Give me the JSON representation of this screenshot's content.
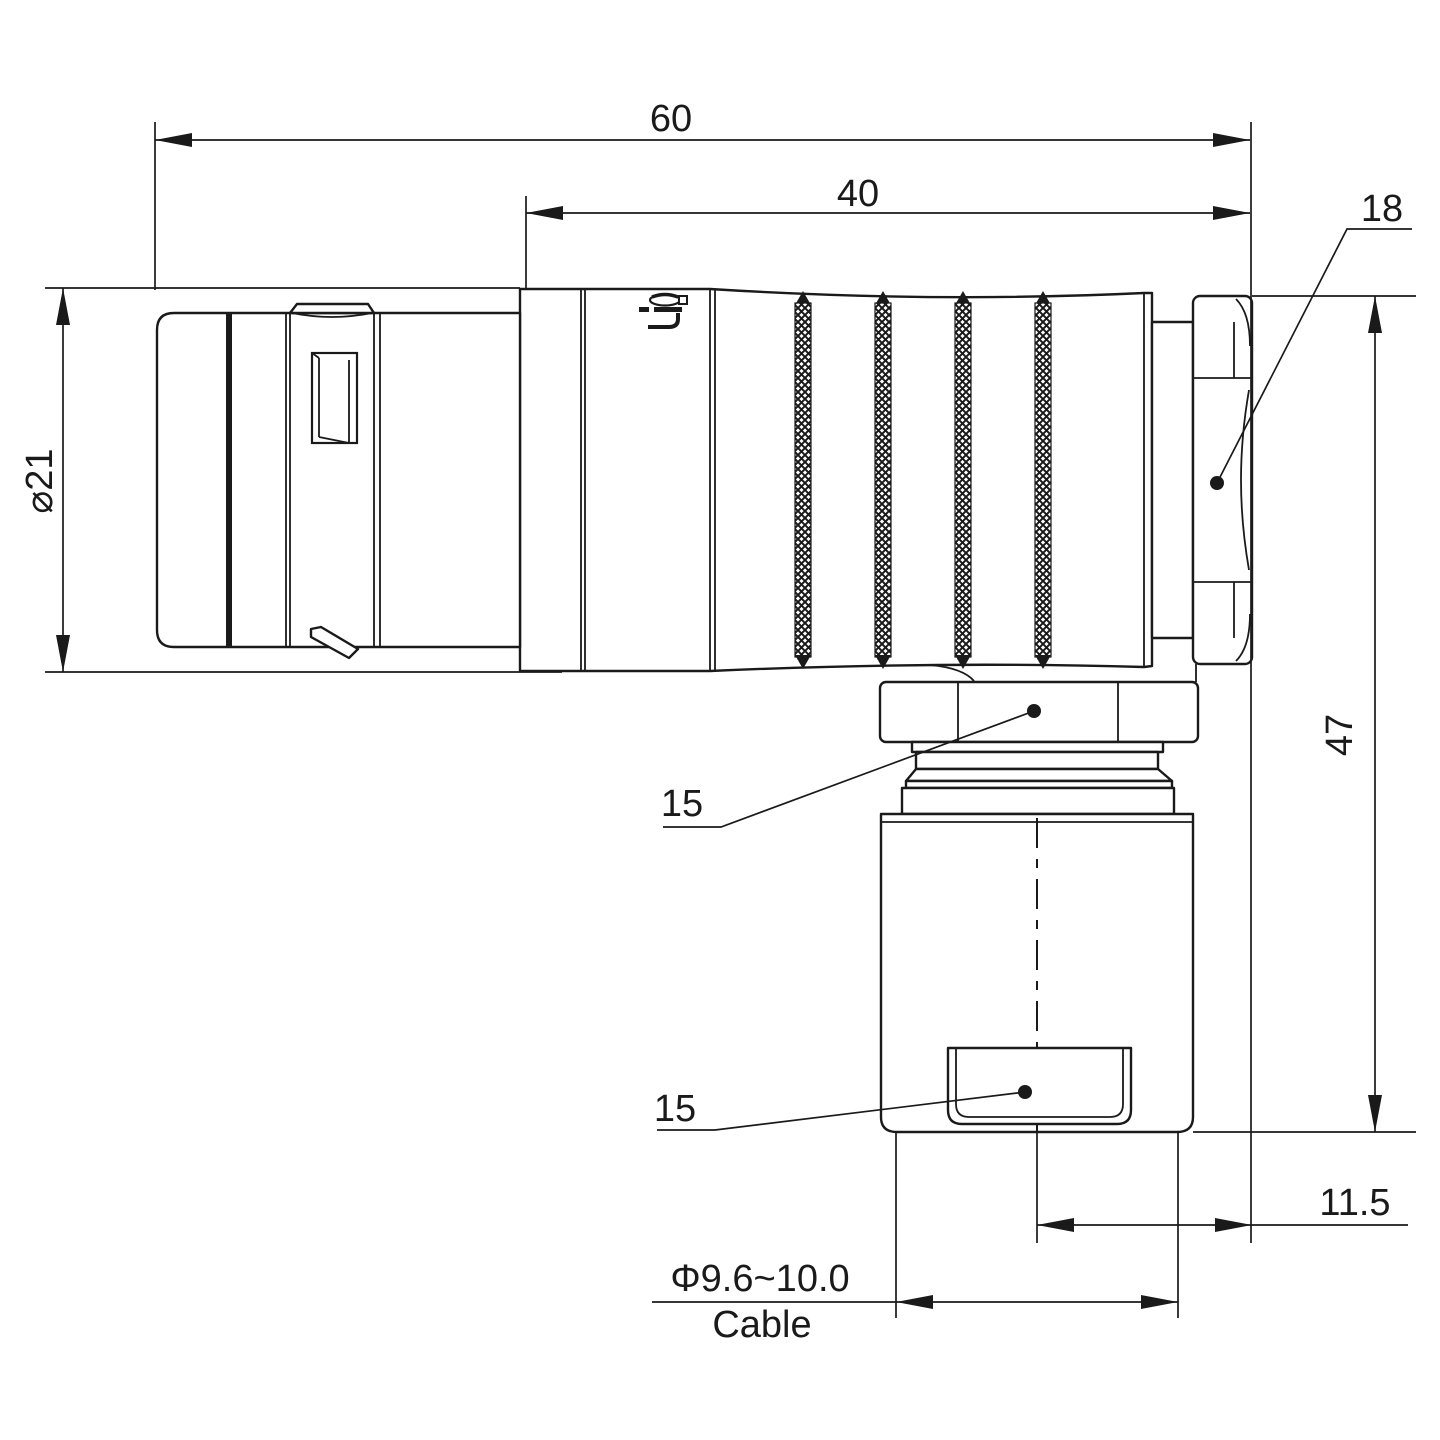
{
  "drawing": {
    "watermark": "Lightany",
    "dimensions": {
      "overall_length": "60",
      "backshell_length": "40",
      "nut_across_flats": "18",
      "shell_diameter": "⌀21",
      "overall_height": "47",
      "coupling_nut_flats": "15",
      "bushing_flats": "15",
      "axis_offset": "11.5",
      "cable_diameter_range": "Φ9.6~10.0",
      "cable_word": "Cable"
    }
  }
}
